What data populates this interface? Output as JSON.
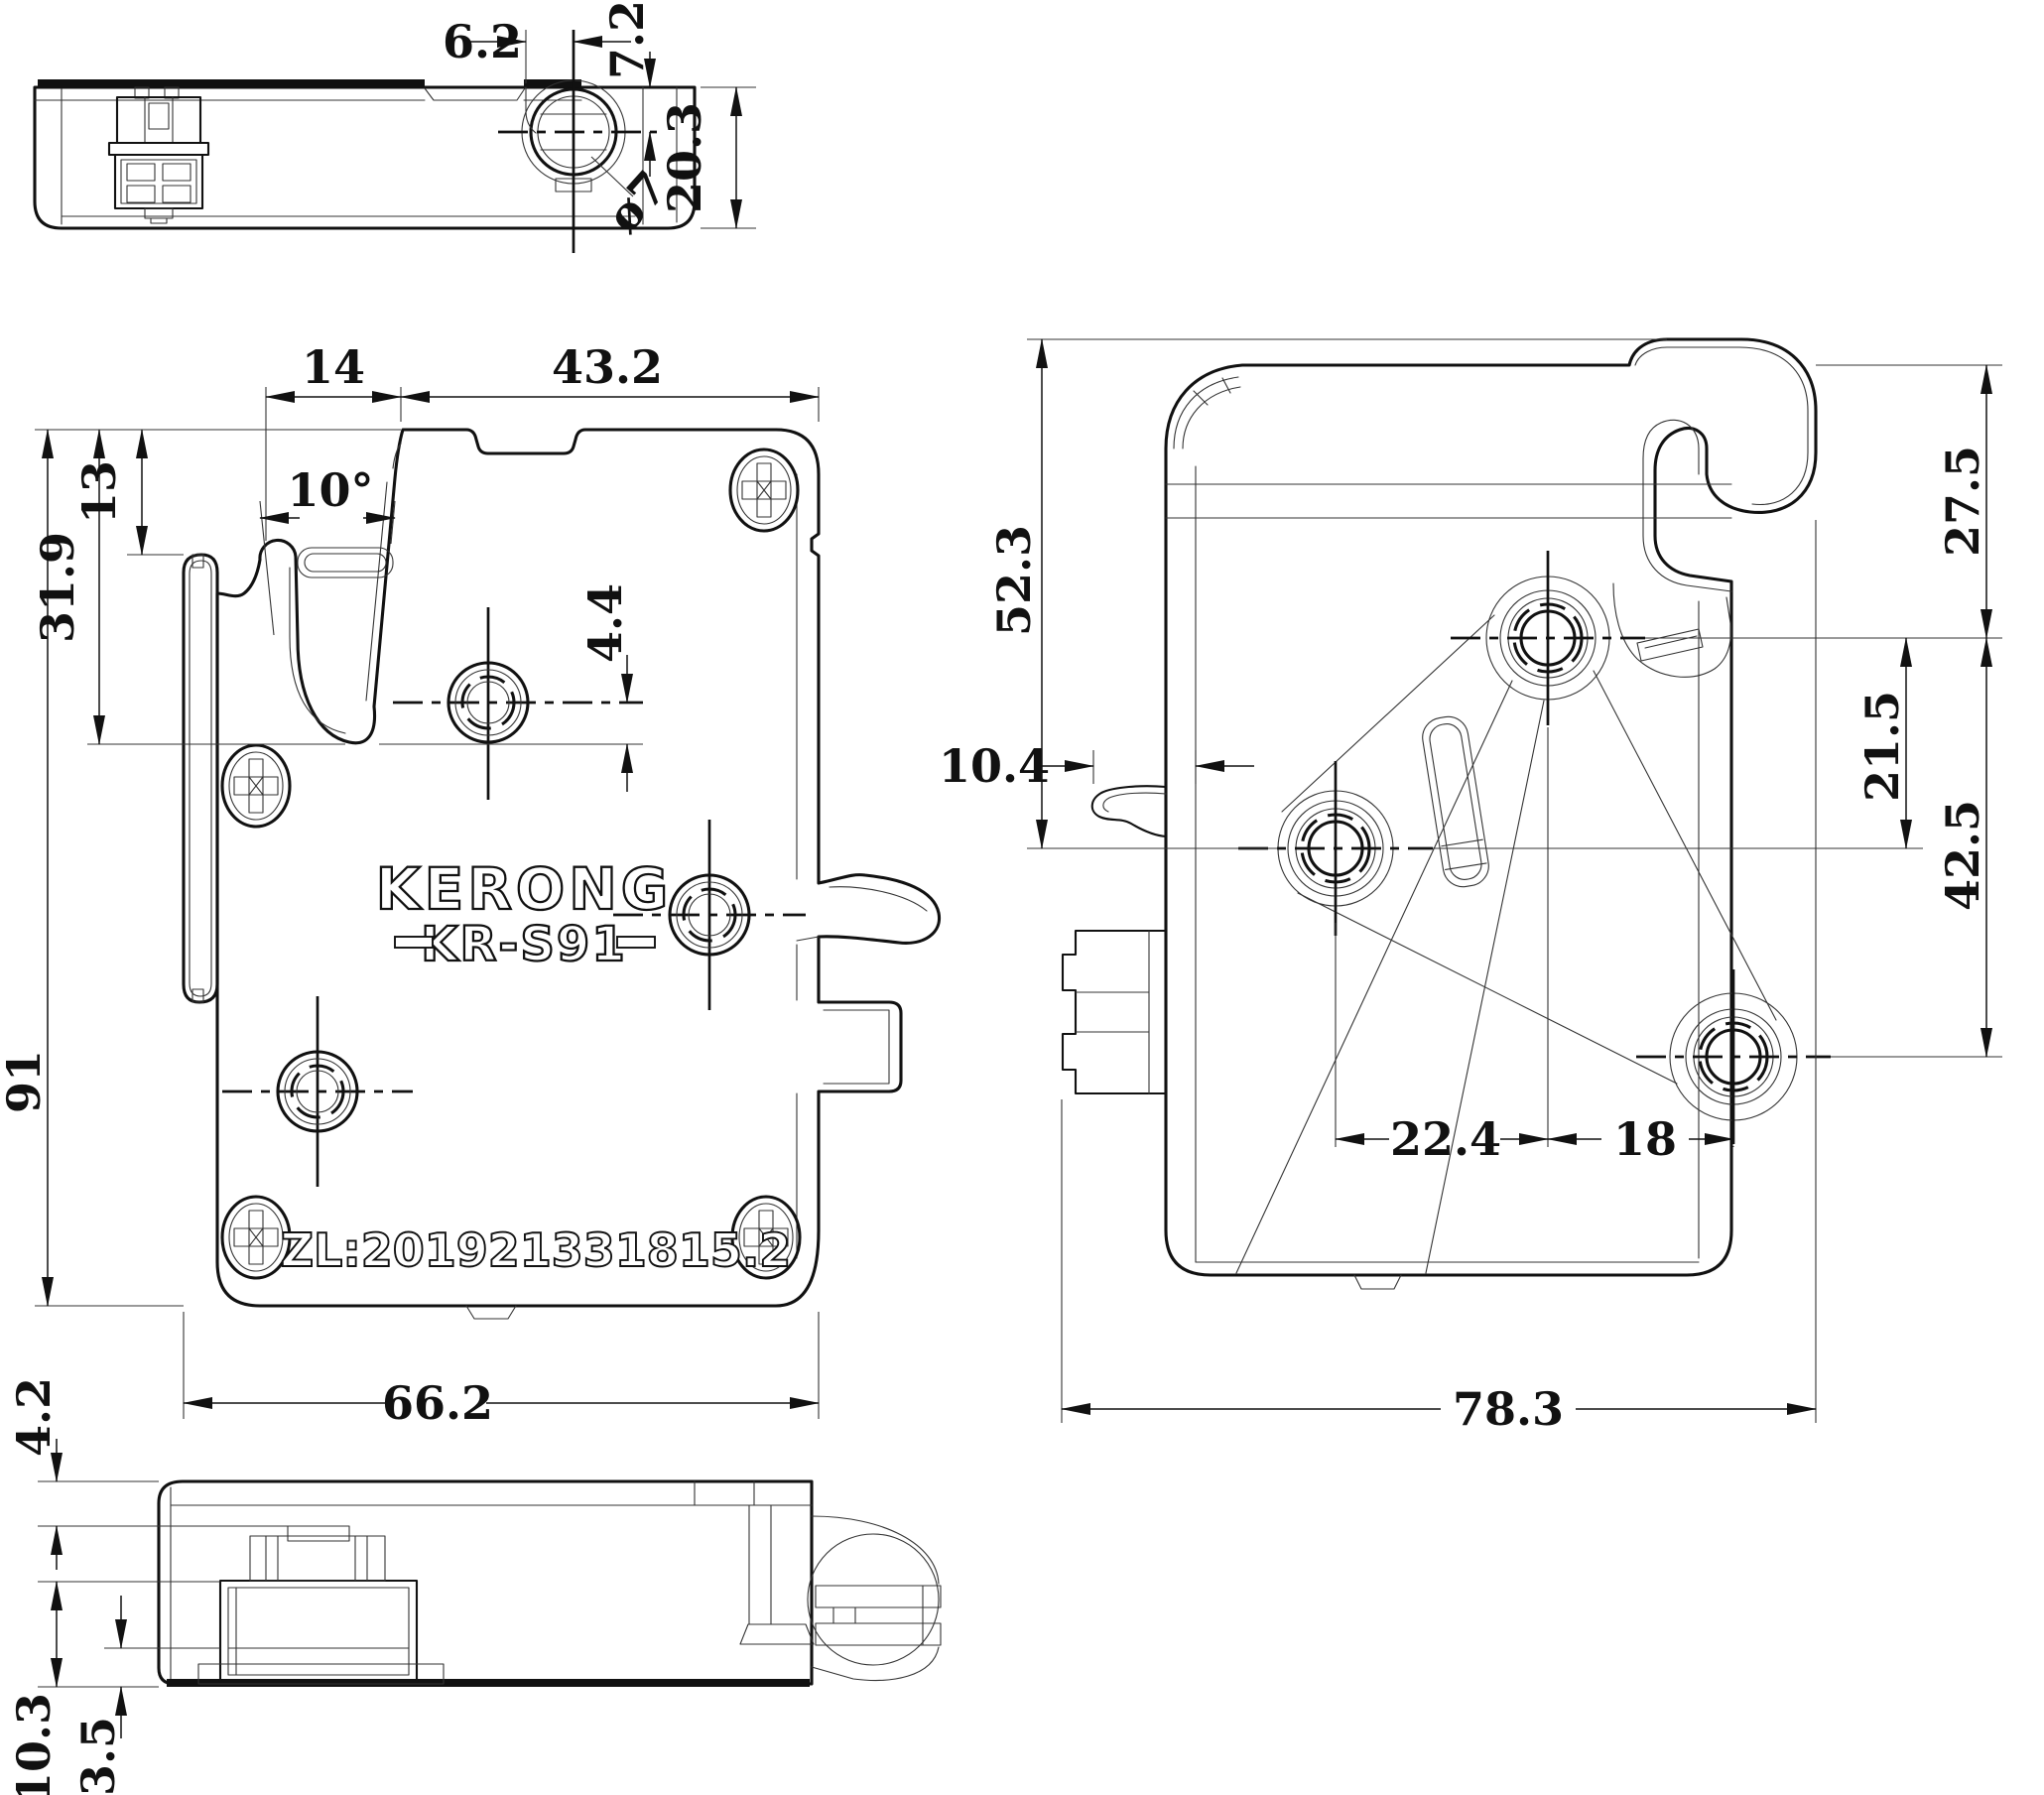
{
  "labels": {
    "brand": "KERONG",
    "model": "KR-S91",
    "patent": "ZL:201921331815.2"
  },
  "dims": {
    "top_offset_x": "6.2",
    "top_offset_y": "7.2",
    "top_height": "20.3",
    "top_diameter": "ø7",
    "front_mouth_width": "14",
    "front_top_width": "43.2",
    "front_tab_depth": "13",
    "front_hook_depth": "31.9",
    "front_angle": "10°",
    "front_hole_offset": "4.4",
    "front_height": "91",
    "front_width": "66.2",
    "right_top_to_hole": "27.5",
    "right_top_to_side_hole": "52.3",
    "right_hole_gap_vertical": "21.5",
    "right_hole_span_vertical": "42.5",
    "right_clip_offset": "10.4",
    "right_hole_gap_left": "22.4",
    "right_hole_gap_right": "18",
    "right_width": "78.3",
    "bottom_step": "4.2",
    "bottom_solenoid_height": "10.3",
    "bottom_base_height": "3.5"
  }
}
